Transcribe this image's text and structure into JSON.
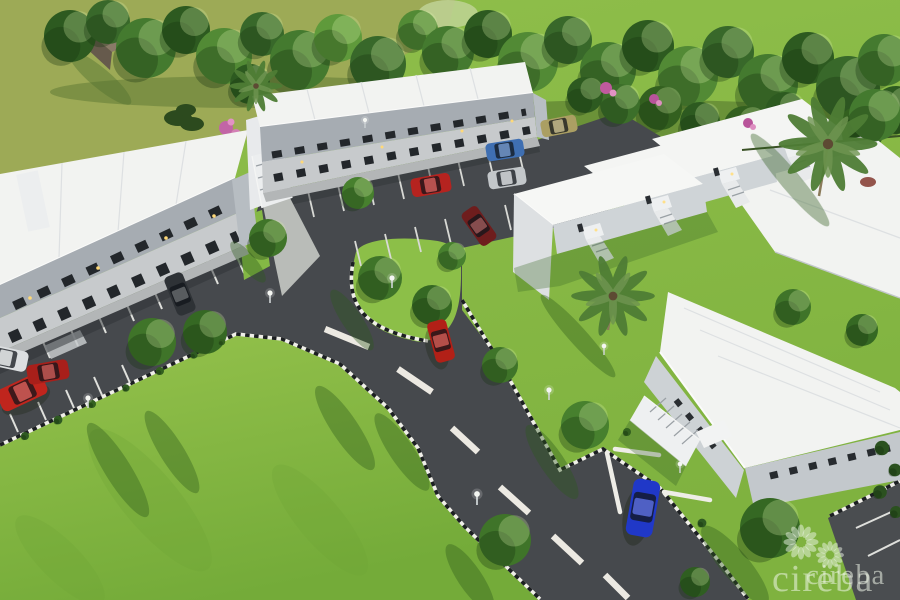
{
  "watermark": {
    "text": "cireba",
    "logo_icon": "cireba-flower-logo",
    "color": "rgba(238,245,232,0.55)"
  },
  "scene": {
    "description": "Aerial 3D architectural rendering of a two-storey apartment complex with parking lots, curved road, lawns, palms and trees",
    "palette": {
      "field_green": "#9daa56",
      "lawn_green": "#8abc47",
      "lawn_deep": "#77ad3b",
      "foliage_dark": "#33601f",
      "pavement_gray": "#46494d",
      "roof_white": "#f2f3f1",
      "wall_upper_gray": "#a6acb2",
      "wall_lower_gray": "#c7cacc",
      "curb_white": "#efeee8",
      "car_blue": "#2038c8",
      "car_red": "#c0251d"
    }
  }
}
